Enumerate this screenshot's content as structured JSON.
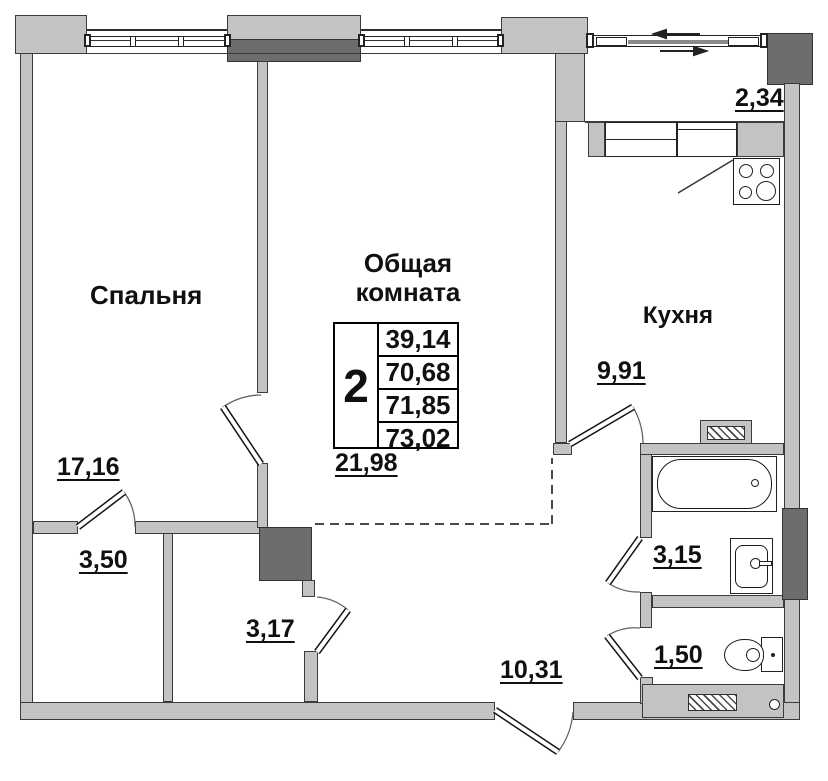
{
  "colors": {
    "wall_fill": "#c3c3c3",
    "wall_dark": "#6d6d6d",
    "outline": "#3c3c3c",
    "text": "#101010"
  },
  "rooms": {
    "bedroom": {
      "name": "Спальня",
      "area": "17,16"
    },
    "living_room": {
      "name_line1": "Общая",
      "name_line2": "комната",
      "area": "21,98"
    },
    "kitchen": {
      "name": "Кухня",
      "area": "9,91"
    },
    "balcony": {
      "area": "2,34"
    },
    "closet_left": {
      "area": "3,50"
    },
    "closet_right": {
      "area": "3,17"
    },
    "hallway": {
      "area": "10,31"
    },
    "bathroom": {
      "area": "3,15"
    },
    "toilet": {
      "area": "1,50"
    }
  },
  "summary_table": {
    "rooms_count": "2",
    "values": [
      "39,14",
      "70,68",
      "71,85",
      "73,02"
    ]
  }
}
